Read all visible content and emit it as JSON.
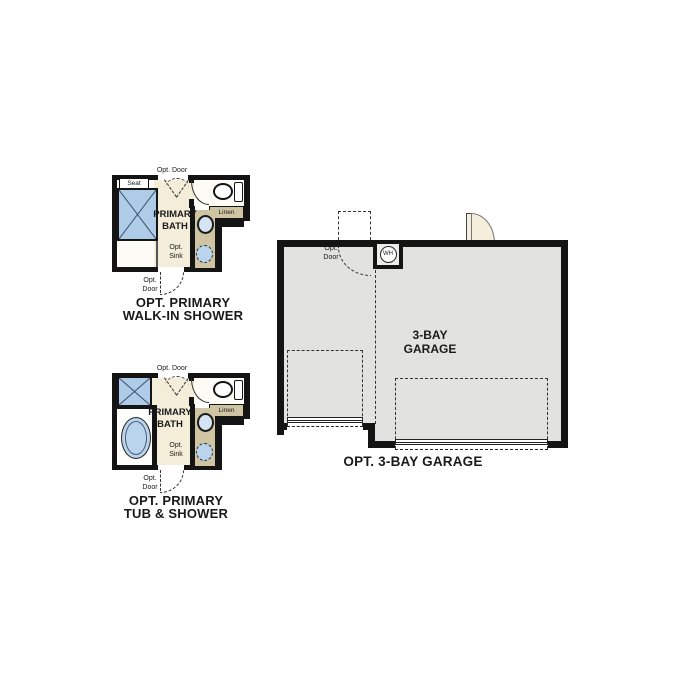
{
  "colors": {
    "wall": "#141414",
    "bath_floor": "#f3edda",
    "room_floor": "#fcfbf5",
    "cabinet_tan": "#cfc5a3",
    "shower_blue": "#aecbe8",
    "water_blue": "#b9d4ec",
    "garage_floor": "#e2e2e0",
    "door_fill": "#f6eedc"
  },
  "plans": {
    "walk_in_shower": {
      "caption": {
        "line1": "OPT. PRIMARY",
        "line2": "WALK-IN SHOWER"
      },
      "labels": {
        "opt_door_top": "Opt. Door",
        "seat": "Seat",
        "room_line1": "PRIMARY",
        "room_line2": "BATH",
        "linen": "Linen",
        "opt_sink_line1": "Opt.",
        "opt_sink_line2": "Sink",
        "opt_door_bottom_line1": "Opt.",
        "opt_door_bottom_line2": "Door"
      }
    },
    "tub_shower": {
      "caption": {
        "line1": "OPT. PRIMARY",
        "line2": "TUB & SHOWER"
      },
      "labels": {
        "opt_door_top": "Opt. Door",
        "room_line1": "PRIMARY",
        "room_line2": "BATH",
        "linen": "Linen",
        "opt_sink_line1": "Opt.",
        "opt_sink_line2": "Sink",
        "opt_door_bottom_line1": "Opt.",
        "opt_door_bottom_line2": "Door"
      }
    },
    "garage": {
      "caption": "OPT. 3-BAY GARAGE",
      "labels": {
        "opt_door_line1": "Opt.",
        "opt_door_line2": "Door",
        "water_heater": "WH",
        "room_line1": "3-BAY",
        "room_line2": "GARAGE"
      }
    }
  }
}
